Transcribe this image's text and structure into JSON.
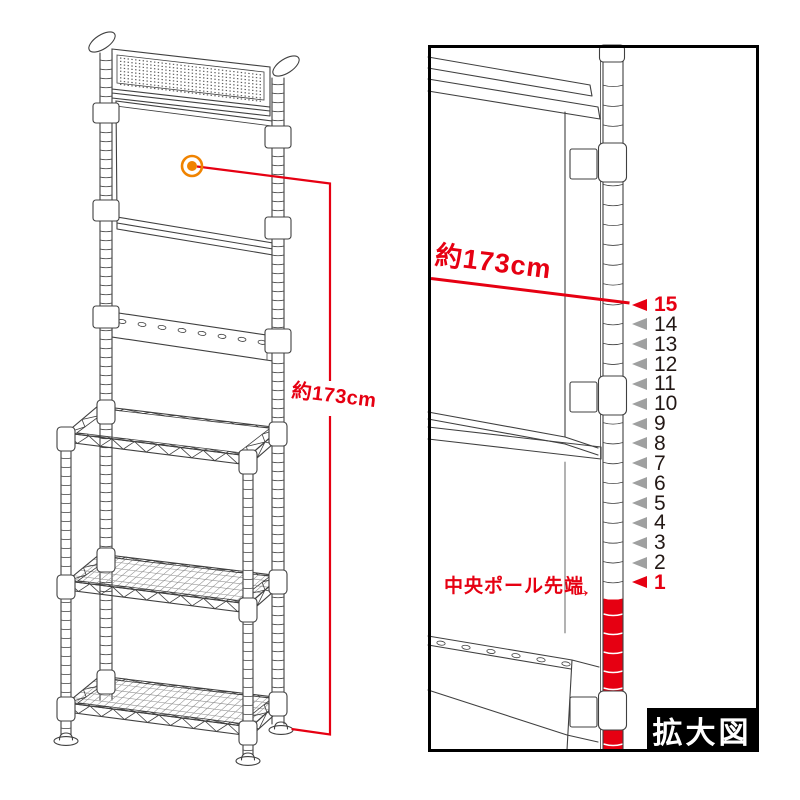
{
  "figure": {
    "left_diagram": {
      "dimension_label": "約173cm",
      "marker": "magnifier-target"
    },
    "magnified_view": {
      "dimension_label": "約173cm",
      "pole_tip_label": "中央ポール先端",
      "pole_tip_arrow": "→",
      "caption": "拡大図",
      "scale_markers": [
        {
          "label": "15",
          "highlight": true
        },
        {
          "label": "14",
          "highlight": false
        },
        {
          "label": "13",
          "highlight": false
        },
        {
          "label": "12",
          "highlight": false
        },
        {
          "label": "11",
          "highlight": false
        },
        {
          "label": "10",
          "highlight": false
        },
        {
          "label": "9",
          "highlight": false
        },
        {
          "label": "8",
          "highlight": false
        },
        {
          "label": "7",
          "highlight": false
        },
        {
          "label": "6",
          "highlight": false
        },
        {
          "label": "5",
          "highlight": false
        },
        {
          "label": "4",
          "highlight": false
        },
        {
          "label": "3",
          "highlight": false
        },
        {
          "label": "2",
          "highlight": false
        },
        {
          "label": "1",
          "highlight": true
        }
      ]
    },
    "colors": {
      "red": "#e60012",
      "orange": "#f08300",
      "line": "#404040",
      "gray_marker": "#9fa0a0",
      "number_text": "#231815",
      "caption_bg": "#000000",
      "caption_text": "#ffffff"
    }
  }
}
